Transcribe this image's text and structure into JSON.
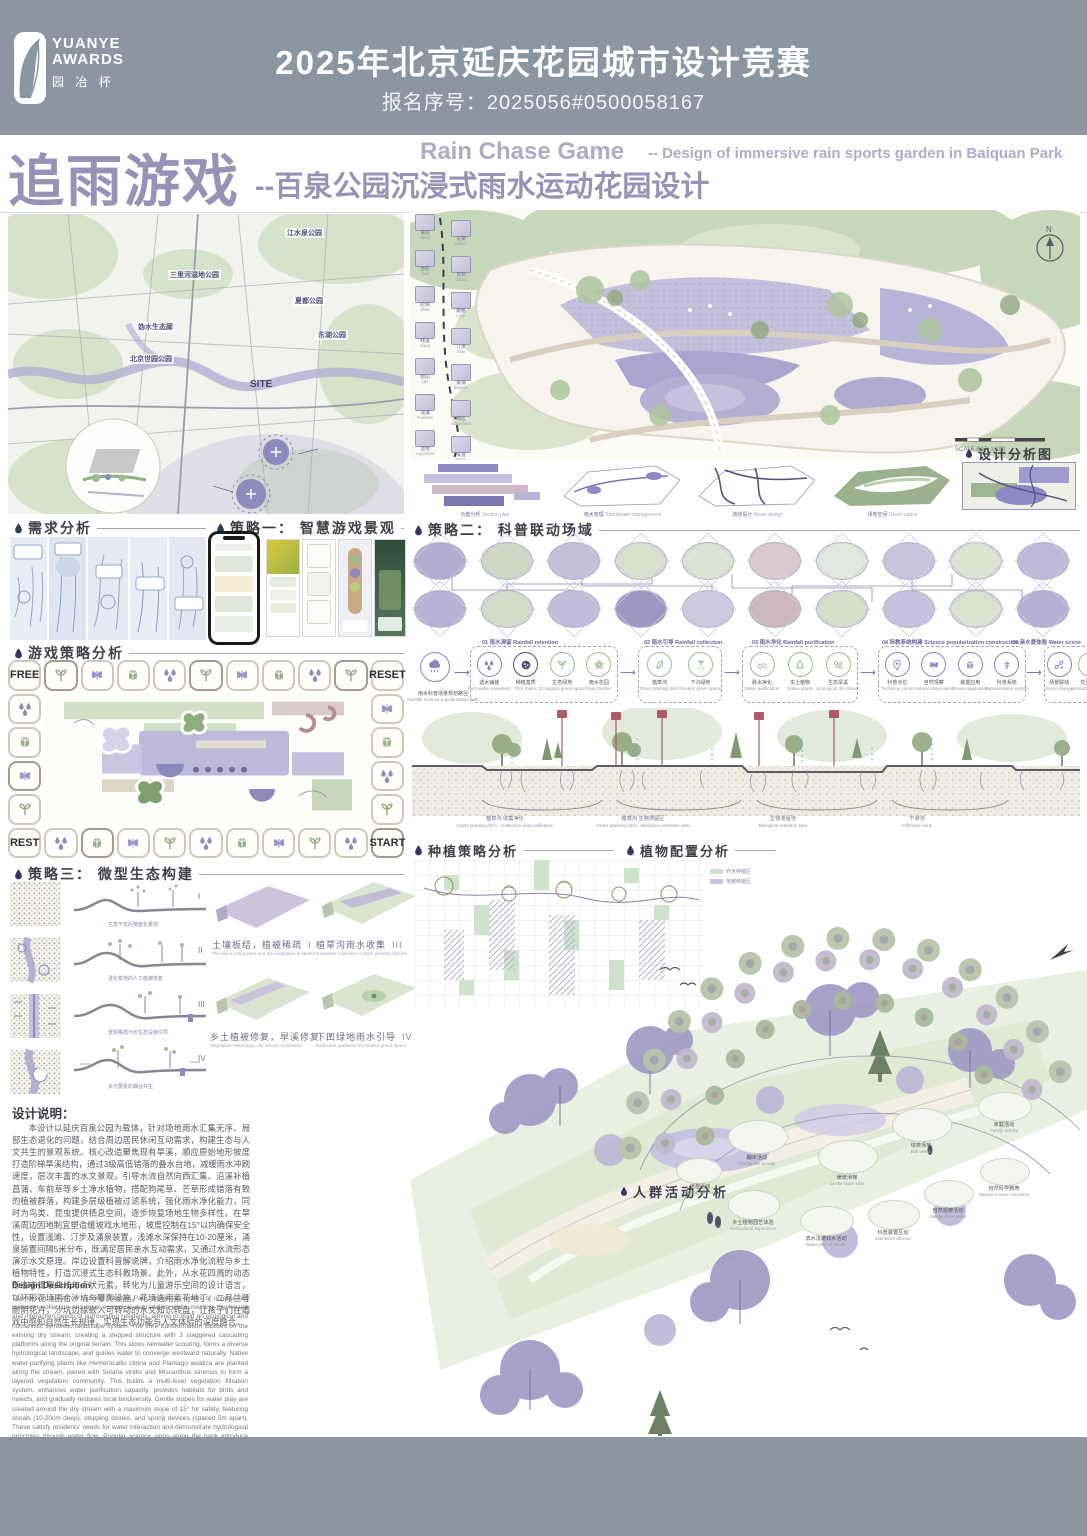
{
  "header": {
    "logo": {
      "line1": "YUANYE",
      "line2": "AWARDS",
      "line3": "园 冶 杯"
    },
    "competition_title": "2025年北京延庆花园城市设计竞赛",
    "registration": "报名序号：2025056#0500058167"
  },
  "title_block": {
    "cn_main": "追雨游戏",
    "cn_sub": "--百泉公园沉浸式雨水运动花园设计",
    "en_main": "Rain Chase Game",
    "en_sub": "-- Design of immersive rain sports garden in Baiquan Park"
  },
  "section_titles": {
    "demand": "需求分析",
    "strategy1": "策略一： 智慧游戏景观",
    "game_analysis": "游戏策略分析",
    "strategy2": "策略二： 科普联动场域",
    "strategy3": "策略三： 微型生态构建",
    "planting": "种植策略分析",
    "plant_config": "植物配置分析",
    "crowd": "人群活动分析",
    "design_analysis": "设计分析图"
  },
  "site_map": {
    "park_labels": [
      "江水泉公园",
      "三里河湿地公园",
      "夏都公园",
      "妫水生态廊",
      "东湖公园",
      "北京世园公园"
    ],
    "site_label": "SITE"
  },
  "board": {
    "corners": {
      "free": "FREE",
      "reset": "RESET",
      "rest": "REST",
      "start": "START"
    },
    "top_icons": [
      "sprout",
      "butterfly",
      "book",
      "drops",
      "sprout",
      "butterfly",
      "book",
      "drops",
      "sprout"
    ],
    "left_icons": [
      "drops",
      "book",
      "butterfly",
      "sprout"
    ],
    "right_icons": [
      "butterfly",
      "book",
      "drops",
      "sprout"
    ],
    "bottom_icons": [
      "drops",
      "book",
      "butterfly",
      "sprout",
      "drops",
      "book",
      "butterfly",
      "sprout",
      "drops"
    ]
  },
  "master_plan": {
    "north_label": "N",
    "scale_label": "SCALE BAR 1:100",
    "feature_tiles_left": [
      {
        "cn": "泉房",
        "en": "Stool"
      },
      {
        "cn": "台阶",
        "en": "Stair"
      },
      {
        "cn": "阶梯",
        "en": "Slide"
      },
      {
        "cn": "栈道",
        "en": "Cond"
      },
      {
        "cn": "假山",
        "en": "Hill"
      },
      {
        "cn": "浅滩",
        "en": "Fountain"
      },
      {
        "cn": "湿地",
        "en": "Aquarium"
      }
    ],
    "feature_tiles_right": [
      {
        "cn": "花架",
        "en": "Gallery"
      },
      {
        "cn": "月洞",
        "en": "Cloud"
      },
      {
        "cn": "跳格",
        "en": "Loop"
      },
      {
        "cn": "汀步",
        "en": "Side"
      },
      {
        "cn": "泉涌",
        "en": "Bounce"
      },
      {
        "cn": "场区",
        "en": "Movement"
      },
      {
        "cn": "溪道",
        "en": "Drop"
      }
    ],
    "analysis_diagrams": [
      {
        "cn": "功能分析",
        "en": "Section plan"
      },
      {
        "cn": "雨水管理",
        "en": "Stormwater management"
      },
      {
        "cn": "流线设计",
        "en": "Route design"
      },
      {
        "cn": "绿地空间",
        "en": "Green space"
      }
    ]
  },
  "science_flow": {
    "path_label_cn": "雨水科普场景规划路径",
    "path_label_en": "Rainfall Science popularization path",
    "groups": [
      {
        "title": "01 雨水滞留 Rainfall retention",
        "items": [
          {
            "cn": "透水铺装",
            "en": "Permeable pavement"
          },
          {
            "cn": "种植基质",
            "en": "Rich matrix"
          },
          {
            "cn": "生态绿地",
            "en": "Ecological green space"
          },
          {
            "cn": "雨水花园",
            "en": "Rain Garden"
          }
        ]
      },
      {
        "title": "02 雨水引导 Rainfall collection",
        "items": [
          {
            "cn": "植草沟",
            "en": "Grass planting ditch"
          },
          {
            "cn": "下沉绿地",
            "en": "Sunken green space"
          }
        ]
      },
      {
        "title": "03 雨水净化 Rainfall purification",
        "items": [
          {
            "cn": "跌水净化",
            "en": "Water purification"
          },
          {
            "cn": "本土植物",
            "en": "Native plants"
          },
          {
            "cn": "生态旱溪",
            "en": "Ecological dry stream"
          }
        ]
      },
      {
        "title": "04 科教系统构建 Science popularization construction",
        "items": [
          {
            "cn": "科普点位",
            "en": "Technical points"
          },
          {
            "cn": "自然观察",
            "en": "Natural observation"
          },
          {
            "cn": "装置应用",
            "en": "Device application"
          },
          {
            "cn": "科普系统",
            "en": "Popularization system"
          }
        ]
      },
      {
        "title": "05 亲水景体验 Water scene",
        "items": [
          {
            "cn": "场景联动",
            "en": "Scene linkage"
          },
          {
            "cn": "交互体验",
            "en": "Interactive Linkage"
          }
        ]
      }
    ]
  },
  "stream_section": {
    "zones": [
      {
        "cn": "植草沟 收集净化",
        "en": "Grass planting ditch · Collection and purification"
      },
      {
        "cn": "植草沟 生物滞留区",
        "en": "Grass planting ditch · Biological retention tank"
      },
      {
        "cn": "生物滞留池",
        "en": "Biological retention tank"
      },
      {
        "cn": "下渗池",
        "en": "Infiltration tank"
      }
    ]
  },
  "strategy3": {
    "sections": [
      {
        "num": "I",
        "caption": "生态干扰后荒废化景观"
      },
      {
        "num": "II",
        "caption": "退化荒地的人工植被恢复"
      },
      {
        "num": "III",
        "caption": "景观格局与水生态设施引导"
      },
      {
        "num": "IV",
        "caption": "多元要素的耦合共生"
      }
    ],
    "plates": [
      {
        "num": "I",
        "cn": "土壤板结，植被稀疏",
        "en": "The soil is compacted and the vegetation is sparse"
      },
      {
        "num": "III",
        "cn": "植草沟雨水收集",
        "en": "Rainwater collected in grass planting ditches"
      },
      {
        "num": "II",
        "cn": "乡土植被修复，旱溪修复",
        "en": "Vegetation restoration, dry stream restoration"
      },
      {
        "num": "IV",
        "cn": "下凹绿地雨水引导",
        "en": "Rainwater guidance for sunken green space"
      }
    ]
  },
  "planting_legend": [
    {
      "label": "乔木种植区"
    },
    {
      "label": "地被种植区"
    }
  ],
  "design_notes": {
    "cn_title": "设计说明：",
    "cn_body": "本设计以延庆百泉公园为载体，针对场地雨水汇集无序、局部生态退化的问题，结合周边居民休闲互动需求，构建生态与人文共生的景观系统。核心改造聚焦现有旱溪，顺应原始地形坡度打造阶梯旱溪结构，通过3级高低错落的叠水台地，减缓雨水冲刷速度，层次丰富的水文景观，引导水流自然向西汇集。沿溪补植菖蒲、车前草等乡土净水植物，搭配狗尾草、芒草形成错落有致的植被群落，构建多层级植被过滤系统，强化雨水净化能力，同时为鸟类、昆虫提供栖息空间，逐步恢复场地生物多样性。在旱溪周边因地制宜塑造缓坡戏水地形，坡度控制在15°以内确保安全性，设置浅滩、汀步及涌泉装置，浅滩水深保持在10-20厘米，涌泉装置间隔5米分布，既满足居民亲水互动需求，又通过水流形态演示水文原理。岸边设置科普解说牌，介绍雨水净化流程与乡土植物特性，打造沉浸式生态科教场景。此外，从水花四溅的动态形态中提取曲线与点状元素，转化为儿童游乐空间的设计语言，以环形花境围合沙坑与攀爬设施，花境选用紫花地丁、二月兰等耐阴花卉，沙坑边缘嵌入可转动的水文知识转盘，让孩子们在嬉戏中感知自然生长规律，实现生态功能与人文体验的深度融合。",
    "en_title": "Design Description",
    "en_body": "This design, based on Yanqing Baiquan Park, addresses issues of unregulated rainwater collection and local ecological degradation while meeting the leisure and interaction needs of surrounding residents, aiming to build an ecological and humanistic symbiotic landscape system. The core transformation focuses on the existing dry stream, creating a stepped structure with 3 staggered cascading platforms along the original terrain. This slows rainwater scouring, forms a diverse hydrological landscape, and guides water to converge westward naturally. Native water-purifying plants like Hemerocallis citrina and Plantago asiatica are planted along the stream, paired with Setaria viridis and Miscanthus sinensis to form a layered vegetation community. This builds a multi-level vegetation filtration system, enhances water purification capacity, provides habitats for birds and insects, and gradually restores local biodiversity. Gentle slopes for water play are created around the dry stream with a maximum slope of 15° for safety, featuring shoals (10-20cm deep), stepping stones, and spring devices (spaced 5m apart). These satisfy residents' needs for water interaction and demonstrate hydrological principles through water flow. Popular science signs along the bank introduce rainwater purification processes and native plant characteristics, creating an immersive ecological education scene. In addition, curve and dot elements extracted from splashing water are transformed into the design language of children's play spaces. Sandpits and climbing facilities are enclosed by circular flower borders planted with shade-tolerant flowers like Viola philippica and Orychophragmus violaceus. Rotatable hydrological knowledge turntables are embedded at the edge of sandpits, allowing children to perceive natural growth laws while playing and achieving deep integration of ecological functions and humanistic experience."
  },
  "crowd_activities": [
    {
      "cn": "休憩活动",
      "en": "Resting activities"
    },
    {
      "cn": "蹦床活动",
      "en": "Trampoline activity"
    },
    {
      "cn": "缓坡滑梯",
      "en": "Gentle slope slide"
    },
    {
      "cn": "球类场地",
      "en": "Ball venue"
    },
    {
      "cn": "家庭活动",
      "en": "Family activity"
    },
    {
      "cn": "乡土植物园艺体验",
      "en": "Horticultural experience"
    },
    {
      "cn": "滨水浅滩戏水活动",
      "en": "Water play on shoals"
    },
    {
      "cn": "科普装置互动",
      "en": "Interactive devices"
    },
    {
      "cn": "自然观察活动",
      "en": "Nature observation"
    },
    {
      "cn": "自然科学教育",
      "en": "Natural science education"
    }
  ],
  "colors": {
    "header_bg": "#8c96a1",
    "accent_purple": "#9b93b8",
    "ink": "#3f3f4a",
    "pastel_lavender": "#bcb6d8",
    "pastel_green": "#cfe0c6"
  }
}
